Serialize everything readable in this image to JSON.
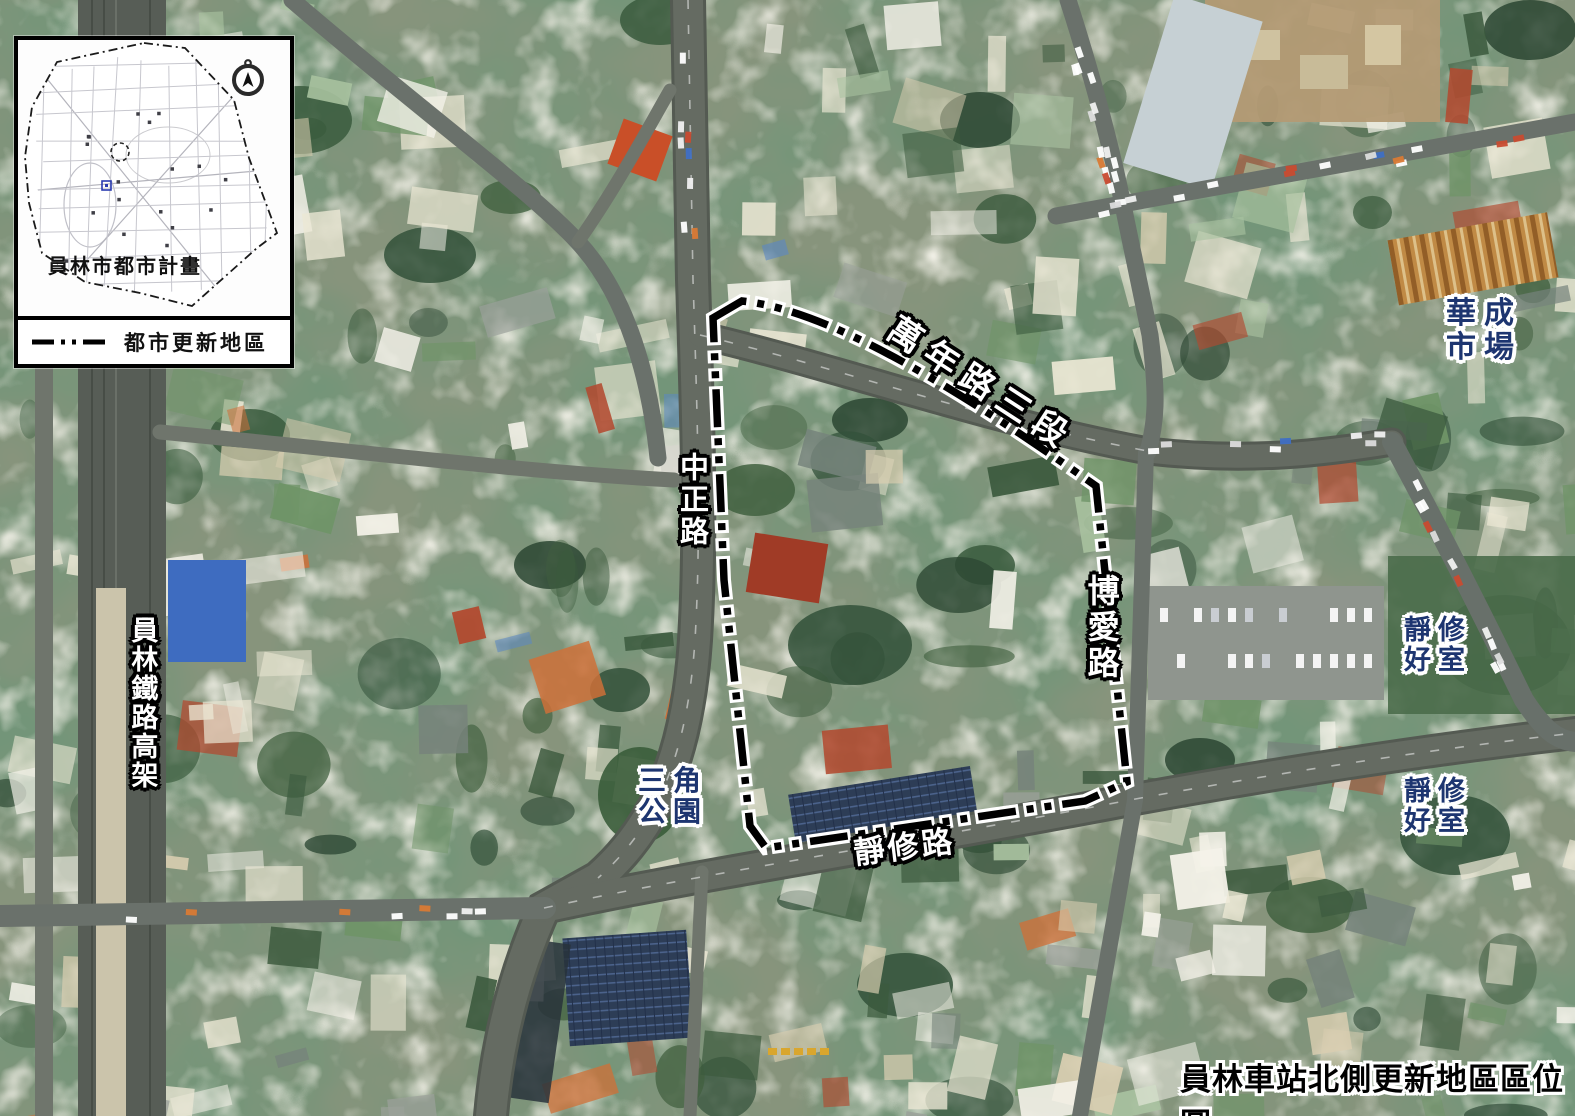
{
  "inset": {
    "title": "員林市都市計畫",
    "legend_label": "都市更新地區",
    "legend_line_style": "dash-dot-dot",
    "compass_icon": "north-compass"
  },
  "road_labels": {
    "wannian": "萬年路三段",
    "zhongzheng": "中正路",
    "boai": "博愛路",
    "jingxiu": "靜修路",
    "railway": "員林鐵路高架"
  },
  "place_labels": {
    "huacheng_market": {
      "line1": "華成",
      "line2": "市場"
    },
    "triangle_park": {
      "line1": "三角",
      "line2": "公園"
    },
    "jingxiu_house_north": {
      "line1": "靜修",
      "line2": "好室"
    },
    "jingxiu_house_south": {
      "line1": "靜修",
      "line2": "好室"
    }
  },
  "caption": "員林車站北側更新地區區位圖",
  "colors": {
    "place_label": "#1d3570",
    "road_label_fill": "#ffffff",
    "road_label_outline": "#000000",
    "boundary": "#000000",
    "caption_fill": "#000000"
  }
}
